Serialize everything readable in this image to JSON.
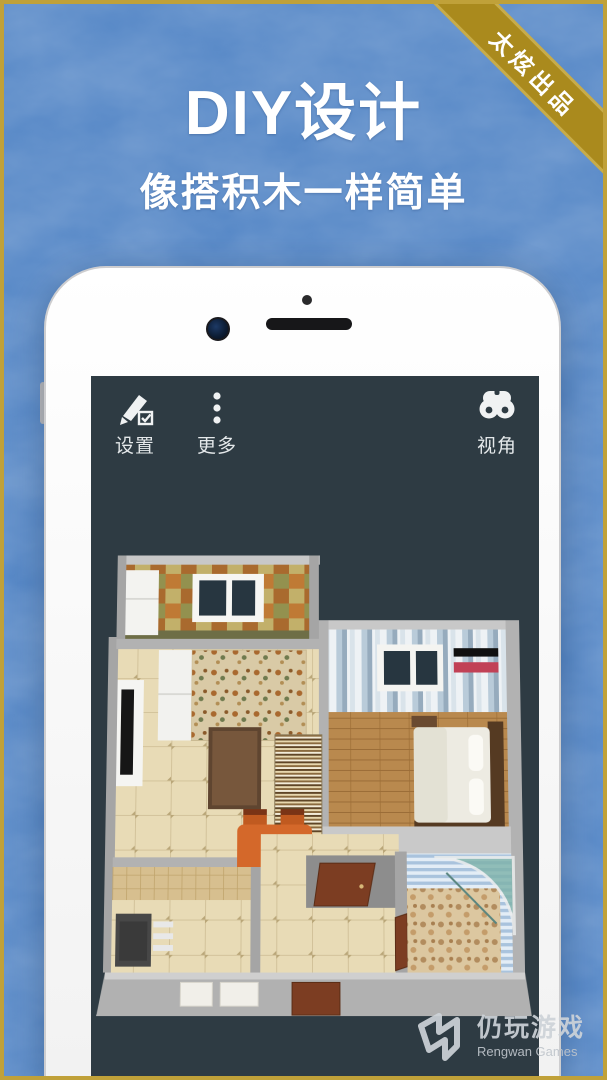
{
  "ribbon": {
    "label": "太炫出品"
  },
  "hero": {
    "title": "DIY设计",
    "subtitle": "像搭积木一样简单"
  },
  "app_toolbar": {
    "settings_label": "设置",
    "more_label": "更多",
    "view_label": "视角"
  },
  "watermark": {
    "name_cn": "仍玩游戏",
    "name_en": "Rengwan Games"
  },
  "colors": {
    "background_blue": "#4e82c4",
    "border_gold": "#c0a139",
    "ribbon_gold": "#aa8a1d",
    "screen_dark": "#2e3b43",
    "phone_white": "#fbfbfb",
    "wall_gray": "#b2b2b2",
    "door_brown": "#7c3d22",
    "accent_orange_table": "#d4682a"
  }
}
